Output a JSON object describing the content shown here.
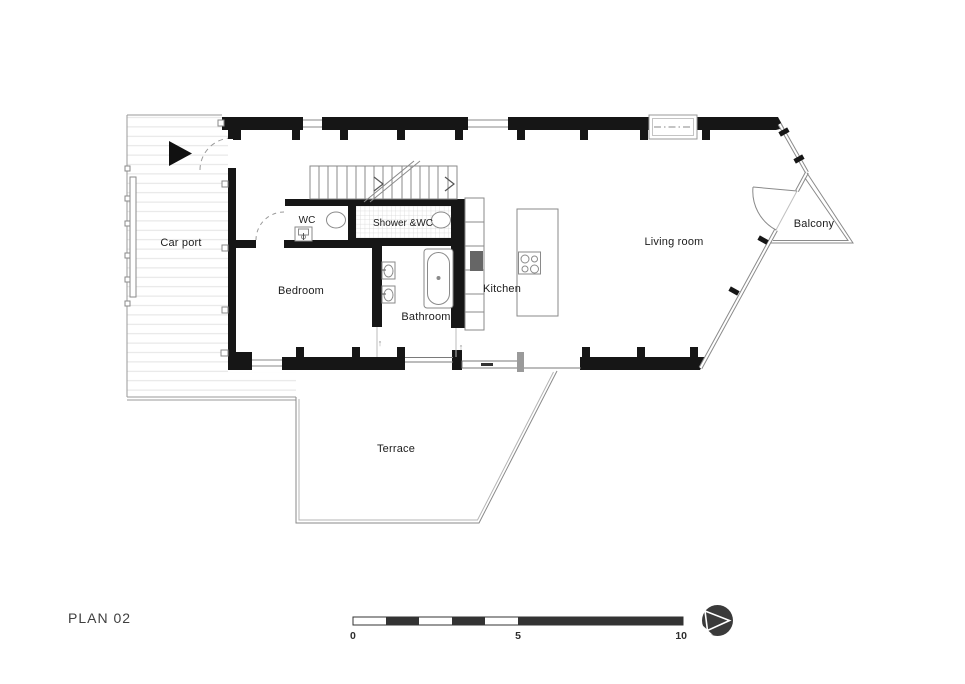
{
  "plan": {
    "title": "PLAN 02",
    "rooms": [
      {
        "id": "car-port",
        "label": "Car port"
      },
      {
        "id": "bedroom",
        "label": "Bedroom"
      },
      {
        "id": "wc",
        "label": "WC"
      },
      {
        "id": "shower-wc",
        "label": "Shower &WC"
      },
      {
        "id": "bathroom",
        "label": "Bathroom"
      },
      {
        "id": "kitchen",
        "label": "Kitchen"
      },
      {
        "id": "living-room",
        "label": "Living room"
      },
      {
        "id": "balcony",
        "label": "Balcony"
      },
      {
        "id": "terrace",
        "label": "Terrace"
      }
    ],
    "annotations": {
      "door_arrow": "↑"
    },
    "scale_bar": {
      "tick_start": "0",
      "tick_mid": "5",
      "tick_end": "10"
    },
    "colors": {
      "wall": "#161616",
      "thin_line": "#7a7a7a",
      "hatch": "#e3e3e3",
      "tile": "#d6d6d6",
      "scale_dark": "#333333",
      "logo": "#3a3a3a"
    }
  }
}
